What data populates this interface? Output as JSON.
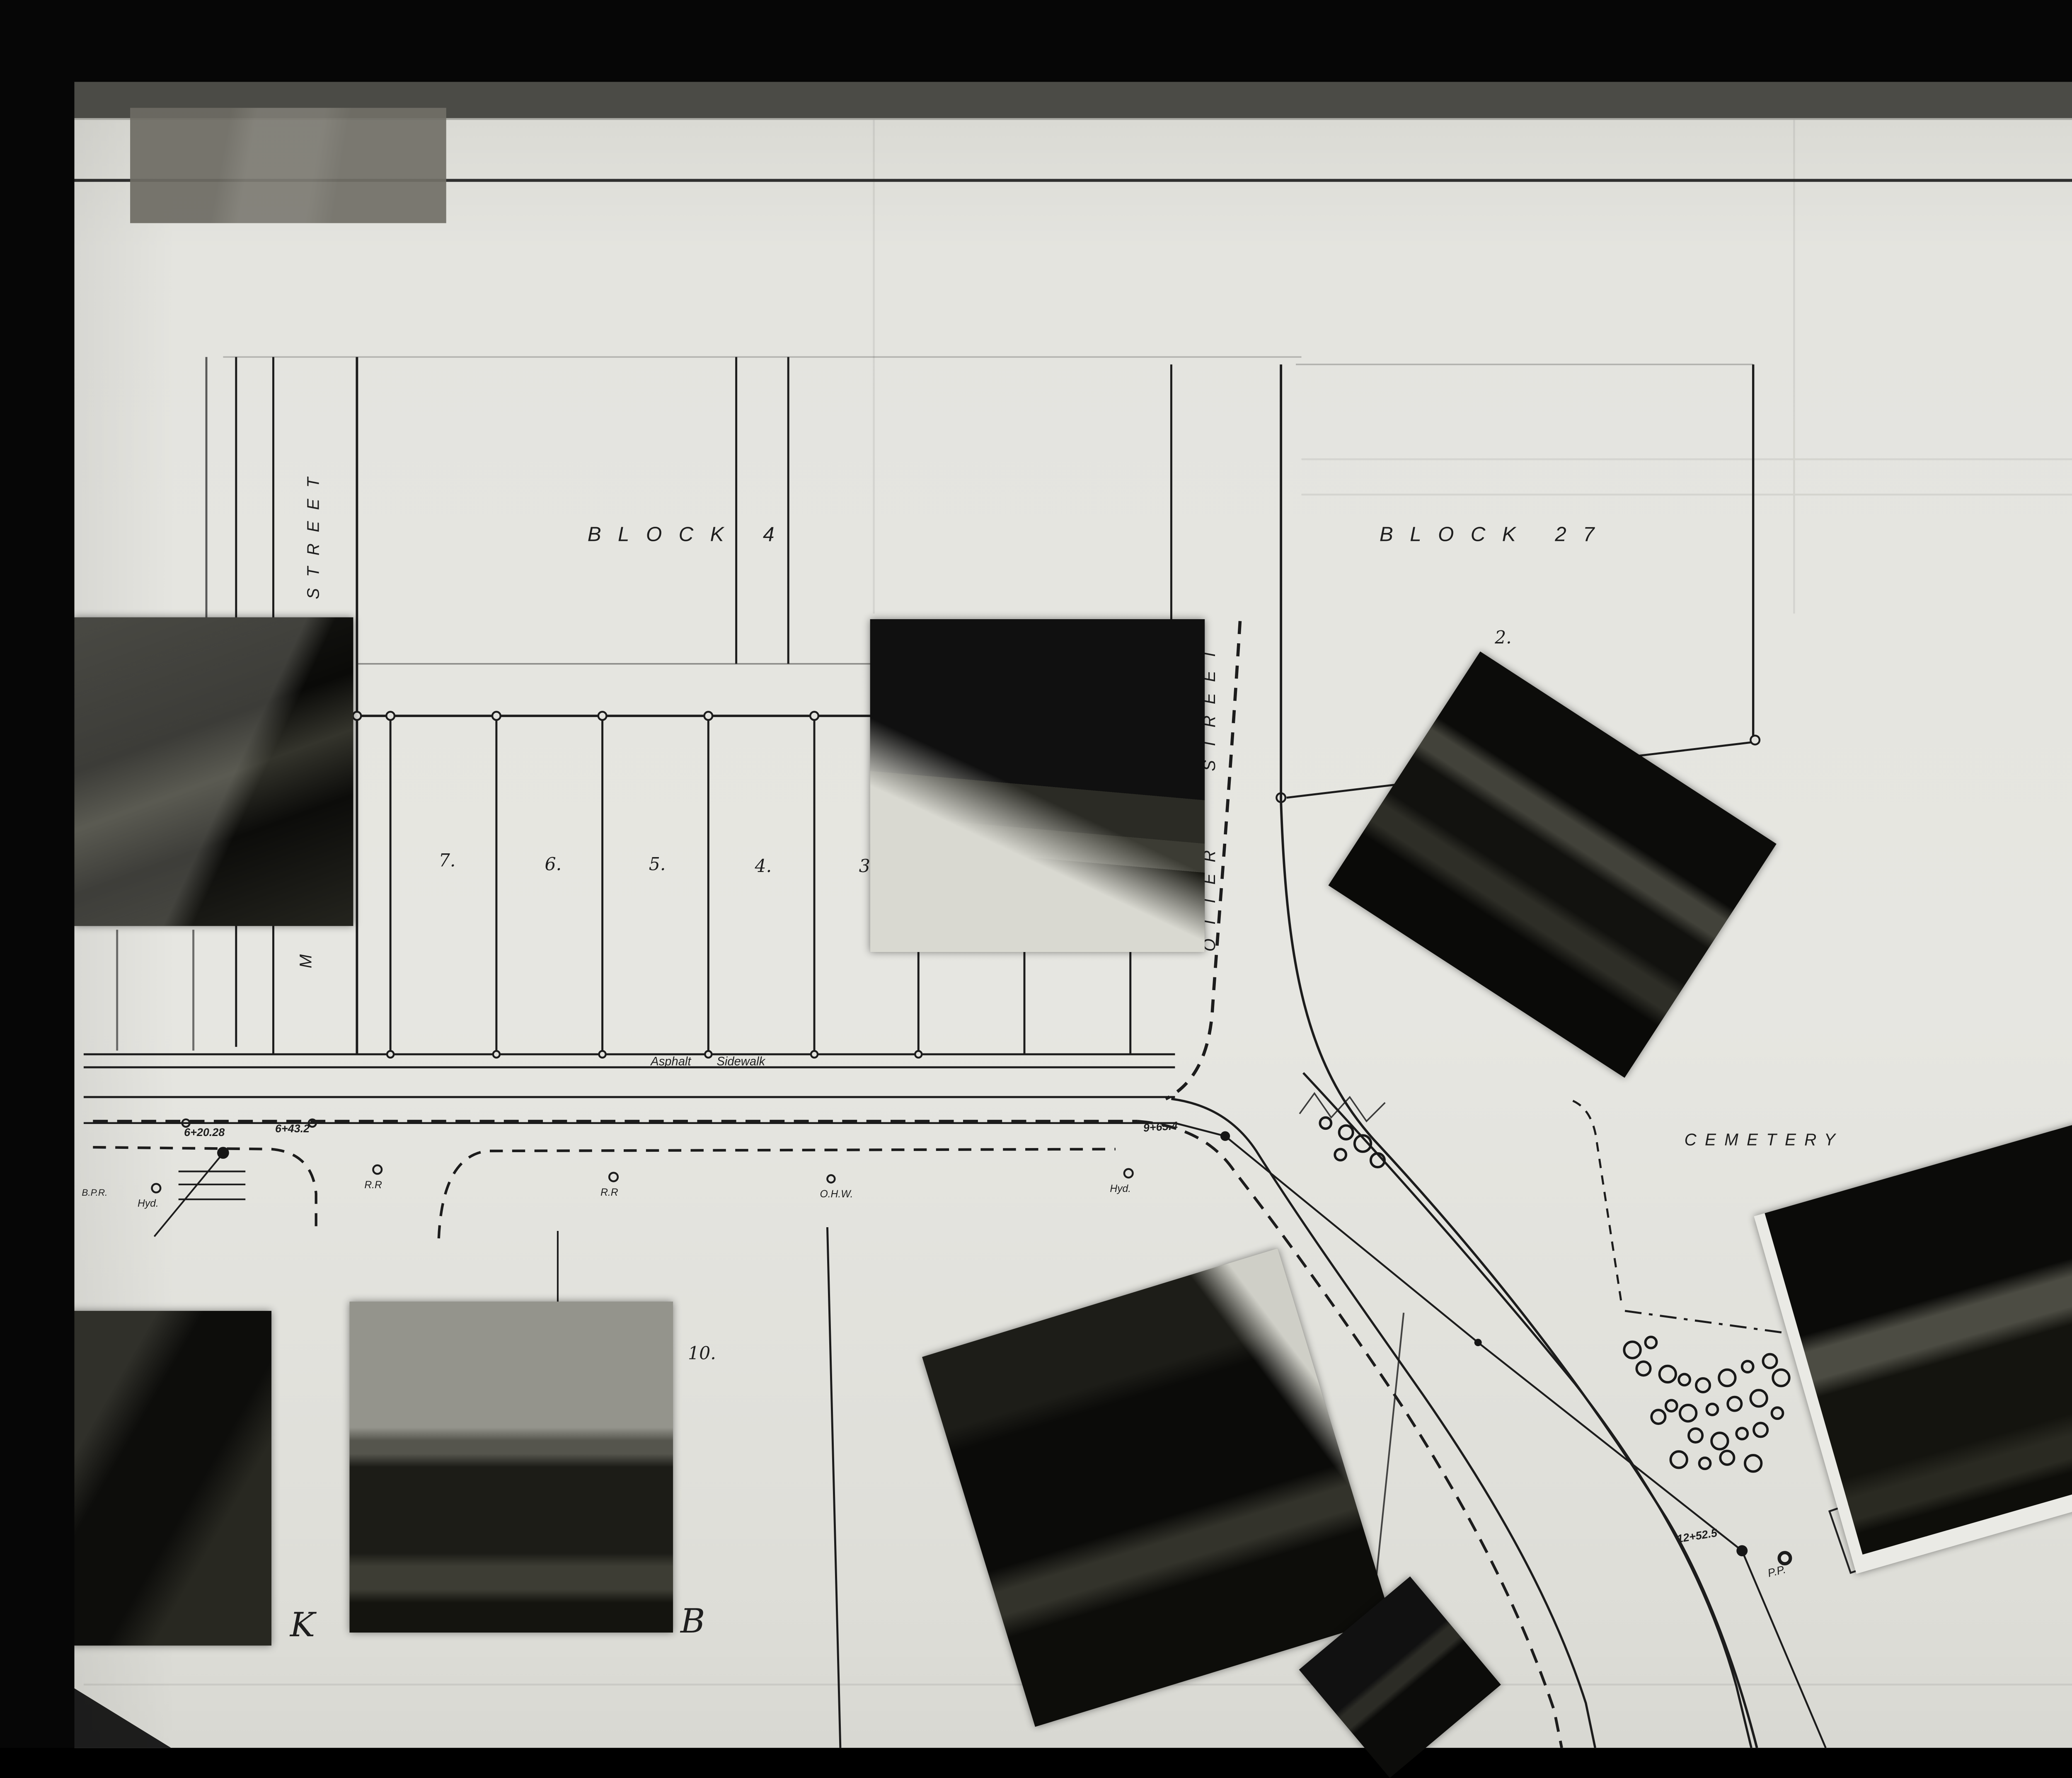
{
  "annotations": {
    "note_line1": "detached from",
    "note_line2": "letter of Sept 2/61",
    "letter_k": "K",
    "letter_b": "B",
    "side_label_number": "2",
    "side_label_code": "OF/DE"
  },
  "map": {
    "block4_label": "BLOCK 4",
    "block27_label": "BLOCK 27",
    "street_left_label": "STREET",
    "street_left_partial": "M U",
    "otter_street_label": "OTTER STREET",
    "cemetery_label": "CEMETERY",
    "sidewalk_label": "Asphalt Sidewalk",
    "north_label": "N",
    "lots": {
      "l7": "7.",
      "l6": "6.",
      "l5": "5.",
      "l4": "4.",
      "l3": "3",
      "l2": "2.",
      "l10": "10.",
      "l11": "11.",
      "l13": "13."
    },
    "stations": {
      "s1": "6+20.28",
      "s2": "6+43.2",
      "s3": "9+65.4",
      "s4": "12+52.5"
    },
    "utilities": {
      "rr1": "R.R",
      "rr2": "R.R",
      "ohw": "O.H.W.",
      "hyd1": "Hyd.",
      "hyd2": "Hyd.",
      "bpr": "B.P.R.",
      "pp": "P.P."
    },
    "substation": {
      "line1": "CALGARY",
      "line2": "POWER",
      "line3": "SUB. STATION"
    },
    "trees": [
      [
        713,
        604
      ],
      [
        724,
        609
      ],
      [
        733,
        615
      ],
      [
        721,
        621
      ],
      [
        741,
        624
      ],
      [
        878,
        726
      ],
      [
        888,
        722
      ],
      [
        884,
        736
      ],
      [
        897,
        739
      ],
      [
        906,
        742
      ],
      [
        916,
        745
      ],
      [
        929,
        741
      ],
      [
        940,
        735
      ],
      [
        952,
        732
      ],
      [
        958,
        741
      ],
      [
        899,
        756
      ],
      [
        892,
        762
      ],
      [
        908,
        760
      ],
      [
        921,
        758
      ],
      [
        933,
        755
      ],
      [
        946,
        752
      ],
      [
        956,
        760
      ],
      [
        912,
        772
      ],
      [
        925,
        775
      ],
      [
        937,
        771
      ],
      [
        947,
        769
      ],
      [
        903,
        785
      ],
      [
        917,
        787
      ],
      [
        929,
        784
      ],
      [
        943,
        787
      ]
    ]
  }
}
